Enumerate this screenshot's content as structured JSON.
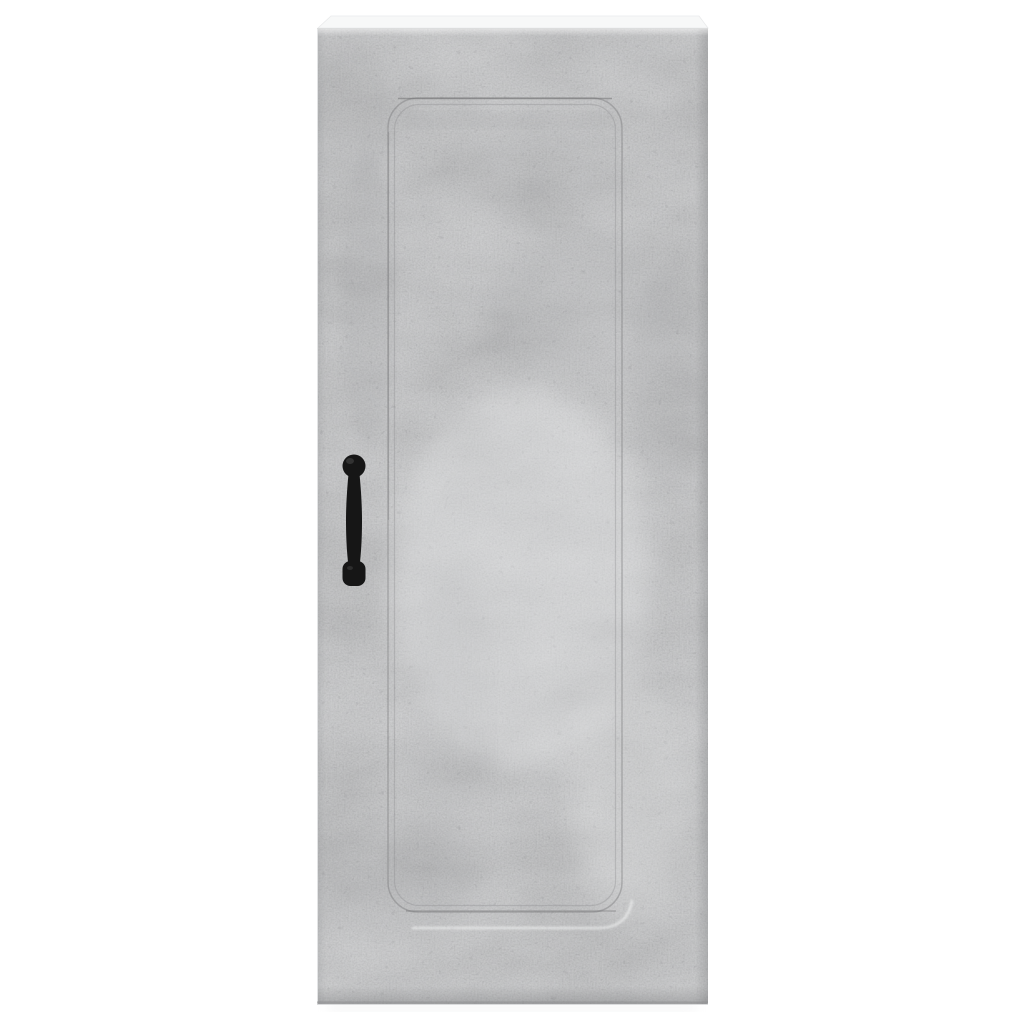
{
  "image": {
    "kind": "product-photo",
    "subject": "Tall narrow wall-mounted cabinet in concrete grey with a black vintage pull handle, front view on white background",
    "body_color_name": "concrete grey",
    "handle_color_name": "black",
    "handle_position": "left-centre of door",
    "panel_style": "recessed rounded-rectangle groove on door front"
  },
  "colors": {
    "background": "#ffffff",
    "concrete_base": "#c3c4c6",
    "concrete_dark": "#9a9b9d",
    "concrete_light": "#e4e5e5",
    "top_surface": "#f7f8f8",
    "top_edge_line": "#dcdddd",
    "groove_line": "#77787a",
    "groove_line_inner": "#8a8b8d",
    "bevel_highlight": "#f0f1f1",
    "bottom_edge_line": "#8f9092",
    "handle": "#161616",
    "handle_highlight": "#4a4a4a",
    "floor_shadow": "#c9cacb"
  }
}
